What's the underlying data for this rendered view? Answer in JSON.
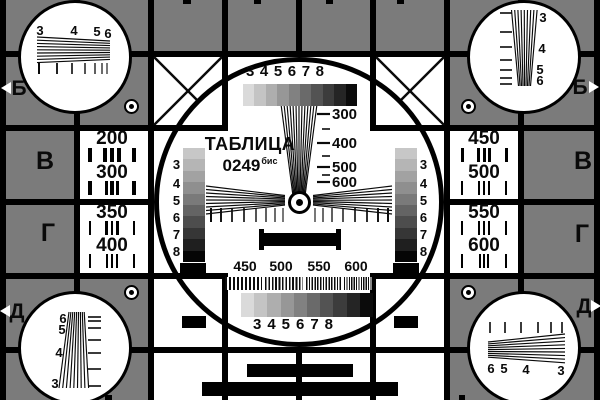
{
  "colors": {
    "background": "#7b7b7b",
    "grid_line": "#000000",
    "panel_white": "#ffffff",
    "ink": "#0a0a0a",
    "grayscale_steps": [
      "#dadada",
      "#c4c4c4",
      "#aeaeae",
      "#979797",
      "#818181",
      "#6a6a6a",
      "#535353",
      "#3c3c3c",
      "#252525",
      "#0b0b0b"
    ],
    "side_grayscale_steps": [
      "#c7c7c7",
      "#b5b5b5",
      "#a2a2a2",
      "#8f8f8f",
      "#7a7a7a",
      "#646464",
      "#4d4d4d",
      "#363636",
      "#1f1f1f",
      "#050505"
    ]
  },
  "center_circle": {
    "title_line1": "ТАБЛИЦА",
    "title_line2": "0249",
    "title_superscript": "бис",
    "top_scale_labels": [
      "3",
      "4",
      "5",
      "6",
      "7",
      "8"
    ],
    "bottom_scale_labels": [
      "3",
      "4",
      "5",
      "6",
      "7",
      "8"
    ],
    "left_grayscale_labels": [
      "3",
      "4",
      "5",
      "6",
      "7",
      "8"
    ],
    "right_grayscale_labels": [
      "3",
      "4",
      "5",
      "6",
      "7",
      "8"
    ],
    "vertical_wedge_labels": [
      "300",
      "400",
      "500",
      "600"
    ],
    "frequency_labels": [
      "450",
      "500",
      "550",
      "600"
    ]
  },
  "left_column": {
    "edge_letters": [
      "Б",
      "В",
      "Г",
      "Д"
    ],
    "resolution_boxes": [
      [
        "200",
        "300"
      ],
      [
        "350",
        "400"
      ]
    ]
  },
  "right_column": {
    "edge_letters": [
      "Б",
      "В",
      "Г",
      "Д"
    ],
    "resolution_boxes": [
      [
        "450",
        "500"
      ],
      [
        "550",
        "600"
      ]
    ]
  },
  "corner_circles": {
    "top_left_labels": [
      "3",
      "4",
      "5",
      "6"
    ],
    "top_right_labels": [
      "3",
      "4",
      "5",
      "6"
    ],
    "bottom_left_labels": [
      "6",
      "5",
      "4",
      "3"
    ],
    "bottom_right_labels": [
      "6",
      "5",
      "4",
      "3"
    ]
  }
}
